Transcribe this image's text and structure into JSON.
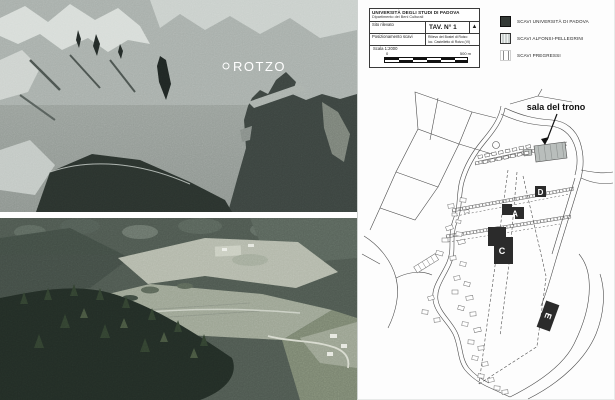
{
  "figure": {
    "satellite": {
      "place_label": "ROTZO"
    },
    "title_block": {
      "institution": "UNIVERSITÀ DEGLI STUDI DI PADOVA",
      "department": "Dipartimento dei Beni Culturali",
      "field1_label": "Sito rilevato",
      "field2_label": "Posizionamento scavi",
      "tav_number": "TAV. N° 1",
      "north_glyph": "▲",
      "sheet_line1": "Rilievo del Bostel di Rotzo",
      "sheet_line2": "loc. Castelletto di Rotzo (VI)",
      "scale_label": "Scala 1:2000",
      "scale_zero": "0",
      "scale_end": "500 m"
    },
    "legend": {
      "items": [
        {
          "label": "SCAVI UNIVERSITÀ DI PADOVA",
          "swatch": "dark-square"
        },
        {
          "label": "SCAVI ALFONSI-PELLEGRINI",
          "swatch": "hatched-square"
        },
        {
          "label": "SCAVI PREGRESSI",
          "swatch": "vertical-lines-square"
        }
      ]
    },
    "site_plan": {
      "annotation": "sala del trono",
      "markers": {
        "a": "A",
        "c": "C",
        "d": "D",
        "e": "E"
      }
    },
    "colors": {
      "excavation_dark": "#2b2b2b",
      "hatch_fill": "#b9bebc",
      "sea_dark": "#3b433f",
      "forest_dark": "#222c25"
    }
  }
}
